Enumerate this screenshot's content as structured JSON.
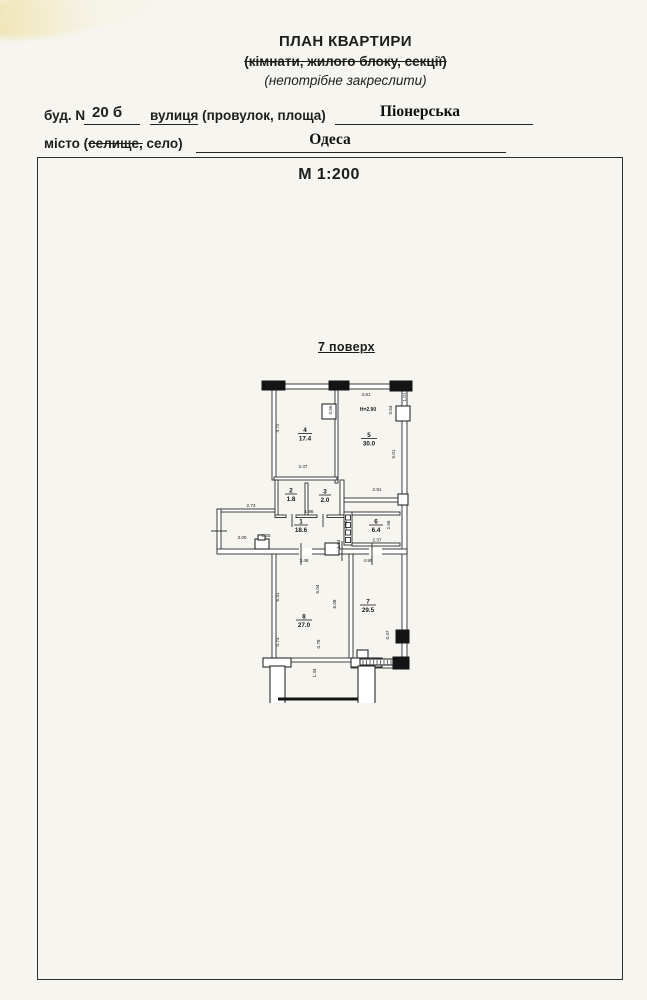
{
  "header": {
    "title": "ПЛАН КВАРТИРИ",
    "subtitle": "(кімнати, жилого блоку, секції)",
    "note": "(непотрібне закреслити)"
  },
  "address": {
    "bud_label": "буд. N",
    "bud_value": "20 б",
    "street_word": "вулиця",
    "street_label_rest": " (провулок, площа)",
    "street_value": "Піонерська",
    "city_pre": "місто (",
    "city_struck": "селище,",
    "city_post": " село)",
    "city_value": "Одеса"
  },
  "scale_label": "М 1:200",
  "plan": {
    "floor_label": "7 поверх",
    "height_note": "Н=2.90",
    "rooms": {
      "r1": {
        "num": "1",
        "area": "18.6"
      },
      "r2": {
        "num": "2",
        "area": "1.8"
      },
      "r3": {
        "num": "3",
        "area": "2.0"
      },
      "r4": {
        "num": "4",
        "area": "17.4"
      },
      "r5": {
        "num": "5",
        "area": "30.0"
      },
      "r6": {
        "num": "6",
        "area": "6.4"
      },
      "r7": {
        "num": "7",
        "area": "29.5"
      },
      "r8": {
        "num": "8",
        "area": "27.0"
      }
    },
    "dims": {
      "r4_left": "4.72",
      "r4_right": "0.55",
      "r4_bottom": "3.37",
      "r5_top": "4.91",
      "r5_corner": "1.01",
      "r5_jamb": "0.54",
      "r5_right": "5.01",
      "r5_bottom": "2.91",
      "r23_bottom": "1.98",
      "hall_top": "2.73",
      "hall_left": "3.00",
      "hall_small": "1.25",
      "vent": "2.64",
      "r6_door": "1.84",
      "r6_right": "2.56",
      "r6_bottom": "2.37",
      "r8_top": "3.48",
      "r7_top": "4.90",
      "r8_left": "6.31",
      "r8_inner": "5.04",
      "r7_left": "6.08",
      "r8_bottom_left": "0.73",
      "r8_bottom_right": "0.78",
      "r7_right": "0.47",
      "balcony": "1.34"
    }
  }
}
